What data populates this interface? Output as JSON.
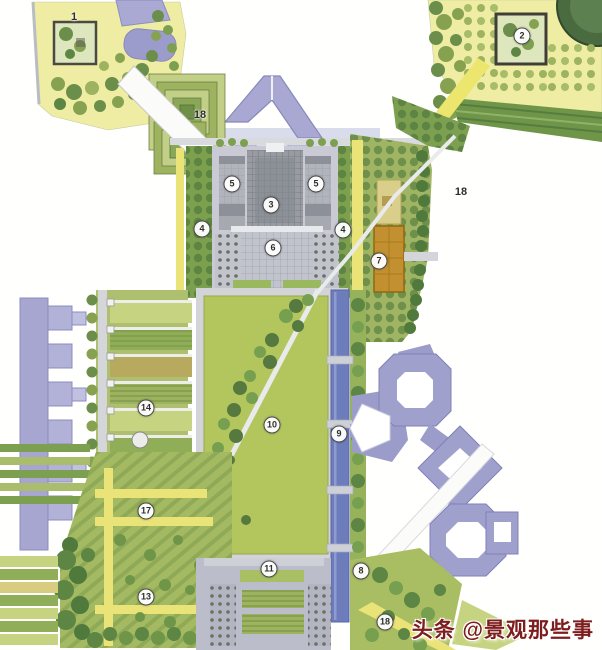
{
  "meta": {
    "type": "landscape-master-plan",
    "description": "Hand-rendered colored landscape architecture master plan with numbered key locations"
  },
  "watermark": {
    "text": "头条 @景观那些事",
    "color": "#7d1d1d"
  },
  "markers": [
    {
      "label": "1",
      "x": 74,
      "y": 17,
      "circled": false
    },
    {
      "label": "2",
      "x": 522,
      "y": 36,
      "circled": true
    },
    {
      "label": "18",
      "x": 200,
      "y": 115,
      "circled": false
    },
    {
      "label": "5",
      "x": 232,
      "y": 184,
      "circled": true
    },
    {
      "label": "5",
      "x": 316,
      "y": 184,
      "circled": true
    },
    {
      "label": "3",
      "x": 271,
      "y": 205,
      "circled": true
    },
    {
      "label": "18",
      "x": 461,
      "y": 192,
      "circled": false
    },
    {
      "label": "4",
      "x": 202,
      "y": 229,
      "circled": true
    },
    {
      "label": "4",
      "x": 343,
      "y": 230,
      "circled": true
    },
    {
      "label": "6",
      "x": 273,
      "y": 248,
      "circled": true
    },
    {
      "label": "7",
      "x": 379,
      "y": 261,
      "circled": true
    },
    {
      "label": "14",
      "x": 146,
      "y": 408,
      "circled": true
    },
    {
      "label": "10",
      "x": 272,
      "y": 425,
      "circled": true
    },
    {
      "label": "9",
      "x": 339,
      "y": 434,
      "circled": true
    },
    {
      "label": "17",
      "x": 146,
      "y": 511,
      "circled": true
    },
    {
      "label": "11",
      "x": 269,
      "y": 569,
      "circled": true
    },
    {
      "label": "8",
      "x": 361,
      "y": 571,
      "circled": true
    },
    {
      "label": "13",
      "x": 146,
      "y": 597,
      "circled": true
    },
    {
      "label": "18",
      "x": 385,
      "y": 622,
      "circled": true
    }
  ],
  "palette": {
    "paper": "#ffffff",
    "garden_yellow": "#efeda4",
    "lawn_green": "#b3c65e",
    "tree_dark": "#5d8544",
    "tree_mid": "#7ca050",
    "building_purple": "#a3a3d0",
    "building_gray": "#9aa0a6",
    "plaza_gray": "#c7c8d2",
    "canal_blue": "#6d7cbb",
    "accent_orange": "#c29030",
    "road_yellow": "#e9e378"
  }
}
